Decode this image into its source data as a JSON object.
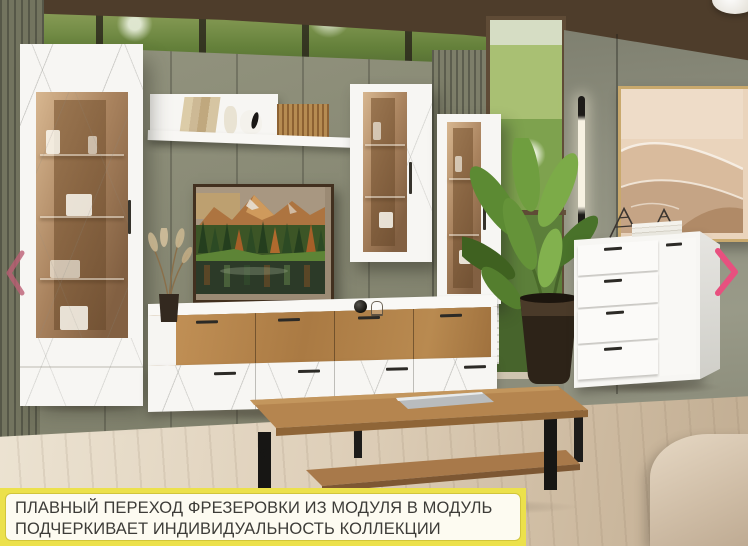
{
  "caption": {
    "line1": "ПЛАВНЫЙ ПЕРЕХОД ФРЕЗЕРОВКИ ИЗ МОДУЛЯ В МОДУЛЬ",
    "line2": "ПОДЧЕРКИВАЕТ ИНДИВИДУАЛЬНОСТЬ КОЛЛЕКЦИИ"
  },
  "carousel": {
    "prev_icon": "chevron-left",
    "next_icon": "chevron-right",
    "prev_color": "#bb5f74",
    "next_color": "#e8507f"
  },
  "palette": {
    "banner_bg": "#ece14b",
    "banner_panel": "#fdfbf1",
    "caption_text": "#3d3c38",
    "wall_olive": "#8c8d7b",
    "oak_wood": "#b1804a",
    "furniture_white": "#f7f6f3",
    "floor_wood": "#dccfbc",
    "ceiling_wood": "#4e3d2b",
    "glass_bronze": "#a97c52",
    "greenery": "#6d9246"
  },
  "scene_objects": [
    "tall display cabinet",
    "wall shelf with decor",
    "landscape picture",
    "two glazed wall cabinets",
    "low tv stand",
    "chest of drawers",
    "oak coffee table with magazine",
    "potted palm plant",
    "dried pampas vase",
    "vertical wall lamp",
    "abstract dune art",
    "beige sofa corner",
    "olive panel wall",
    "floor-to-ceiling window"
  ]
}
